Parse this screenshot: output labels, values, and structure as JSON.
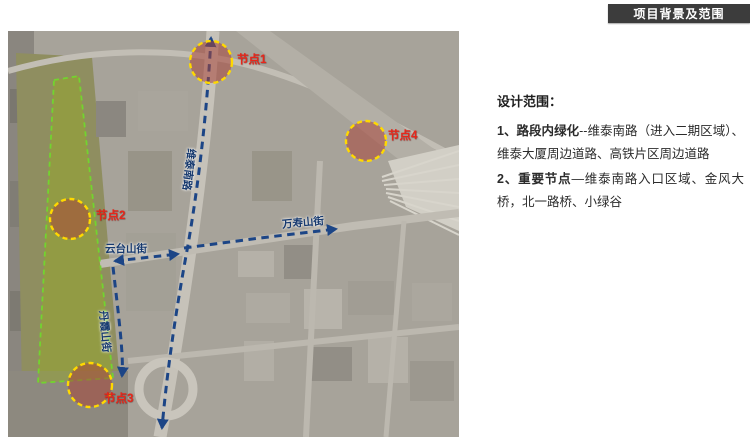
{
  "header": {
    "title": "项目背景及范围"
  },
  "panel": {
    "heading": "设计范围：",
    "item1_prefix": "1、",
    "item1_bold": "路段内绿化",
    "item1_rest": "--维泰南路（进入二期区域）、维泰大厦周边道路、高铁片区周边道路",
    "item2_prefix": "2、",
    "item2_bold": "重要节点",
    "item2_rest": "—维泰南路入口区域、金风大桥，北一路桥、小绿谷"
  },
  "map": {
    "nodes": [
      {
        "label": "节点1"
      },
      {
        "label": "节点2"
      },
      {
        "label": "节点3"
      },
      {
        "label": "节点4"
      }
    ],
    "streets": [
      {
        "label": "维泰南路"
      },
      {
        "label": "云台山街"
      },
      {
        "label": "万寿山街"
      },
      {
        "label": "丹霞山街"
      }
    ],
    "legend_colors": {
      "route_blue": "#1c4586",
      "scope_green": "#72d42f",
      "node_yellow": "#ffd900",
      "node_fill": "#a8463a",
      "label_red": "#e8261a",
      "street_label_navy": "#16396e"
    }
  }
}
